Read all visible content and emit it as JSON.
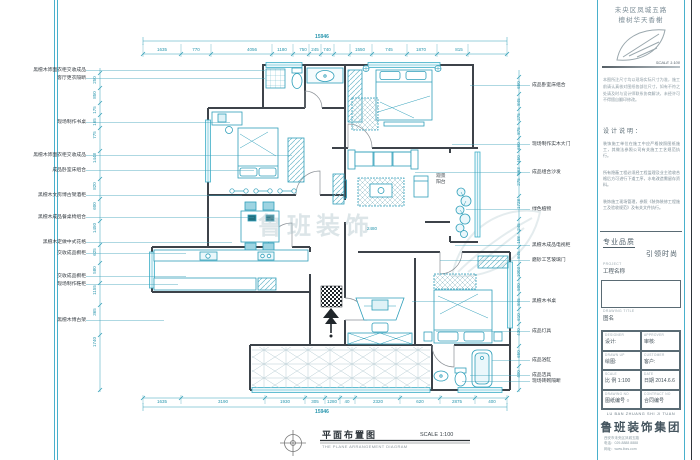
{
  "header": {
    "line1": "未央区凤城五路",
    "line2": "檀树华天香榭"
  },
  "plan": {
    "top_total": "15946",
    "top_segments": [
      "1635",
      "770",
      "4056",
      "1180",
      "750",
      "245",
      "740",
      "1550",
      "745",
      "1870",
      "815"
    ],
    "bottom_segments": [
      "1635",
      "3190",
      "1930",
      "305",
      "1280",
      "40",
      "2320",
      "620",
      "2875",
      "400"
    ],
    "bottom_total": "15946",
    "left_dims": [
      "250",
      "850",
      "175",
      "165",
      "775",
      "1448",
      "820",
      "600",
      "1450",
      "625",
      "580",
      "1155",
      "365",
      "1740"
    ],
    "right_dims": [
      "650",
      "845",
      "275",
      "875",
      "660",
      "450",
      "563",
      "275",
      "1728",
      "245",
      "158",
      "845",
      "1003",
      "500",
      "845",
      "610",
      "430",
      "650",
      "400"
    ],
    "left_labels": [
      "黑檀木饰面衣柜交收成品",
      "客厅更衣隔断",
      "现场制作书桌",
      "黑檀木饰面衣柜交收成品",
      "成品卧室床组合",
      "黑檀木文房博古架酒柜",
      "黑檀木成品餐桌椅组合",
      "黑檀木定做中式花格",
      "交收成品橱柜",
      "交收成品橱柜",
      "现场制作鞋柜",
      "黑檀木博古架"
    ],
    "right_labels": [
      "成品卧室床组合",
      "现场制作实木大门",
      "成品组合沙发",
      "绿色植物",
      "黑檀木成品电视柜",
      "磨砂工艺玻璃门",
      "黑檀木书桌",
      "成品灯具",
      "成品浴缸",
      "成品洁具",
      "现场砖砌隔断"
    ],
    "room_label_balcony": "观景阳台",
    "inner_dim": "2480",
    "watermark": "鲁班装饰"
  },
  "footer": {
    "title": "平面布置图",
    "scale": "SCALE 1:100",
    "caption": "THE PLANE ARRANGEMENT DIAGRAM"
  },
  "titleblock": {
    "scale_small": "SCALE 1:100",
    "intro": "本图所注尺寸均以现场实际尺寸为准，施工前请认真核对图纸各部位尺寸，如有不符之处请及时与设计师联系协商解决，未经许可不得擅自翻印修改。",
    "notes_title": "设计说明：",
    "notes": [
      "装饰施工单位在施工中应严格按照图纸施工，其做法参照公司有关施工工艺规范执行。",
      "所有隐蔽工程必须经工程监理及业主验收合格后方可进行下道工序，水电改造需留存资料。",
      "装饰施工现场管理，参照《装饰装修工程施工及验收规范》及有关文件执行。"
    ],
    "brand_top": "专业品质",
    "brand_bottom": "引领时尚",
    "project_en": "PROJECT",
    "project_cn": "工程名称",
    "drawing_title_en": "DRAWING TITLE",
    "drawing_title_cn": "图名",
    "fields": [
      {
        "en": "DESIGNER",
        "cn": "设计:"
      },
      {
        "en": "APPROVER",
        "cn": "审核:"
      },
      {
        "en": "DRAWN UP",
        "cn": "绘图:"
      },
      {
        "en": "CUSTOMER",
        "cn": "客户:"
      },
      {
        "en": "SCALE",
        "cn": "比 例 1:100"
      },
      {
        "en": "DATE",
        "cn": "日期 2014.6.6"
      },
      {
        "en": "DRAWING NO",
        "cn": "图纸编号 ○"
      },
      {
        "en": "CONTRACT NO",
        "cn": "合同编号"
      }
    ],
    "company_en": "LU BAN ZHUANG SHI JI TUAN",
    "company_cn": "鲁班装饰集团",
    "contact": [
      "西安市未央区凤城五路",
      "电话：029-8888 8888",
      "网址：www.lbzs.com"
    ]
  }
}
